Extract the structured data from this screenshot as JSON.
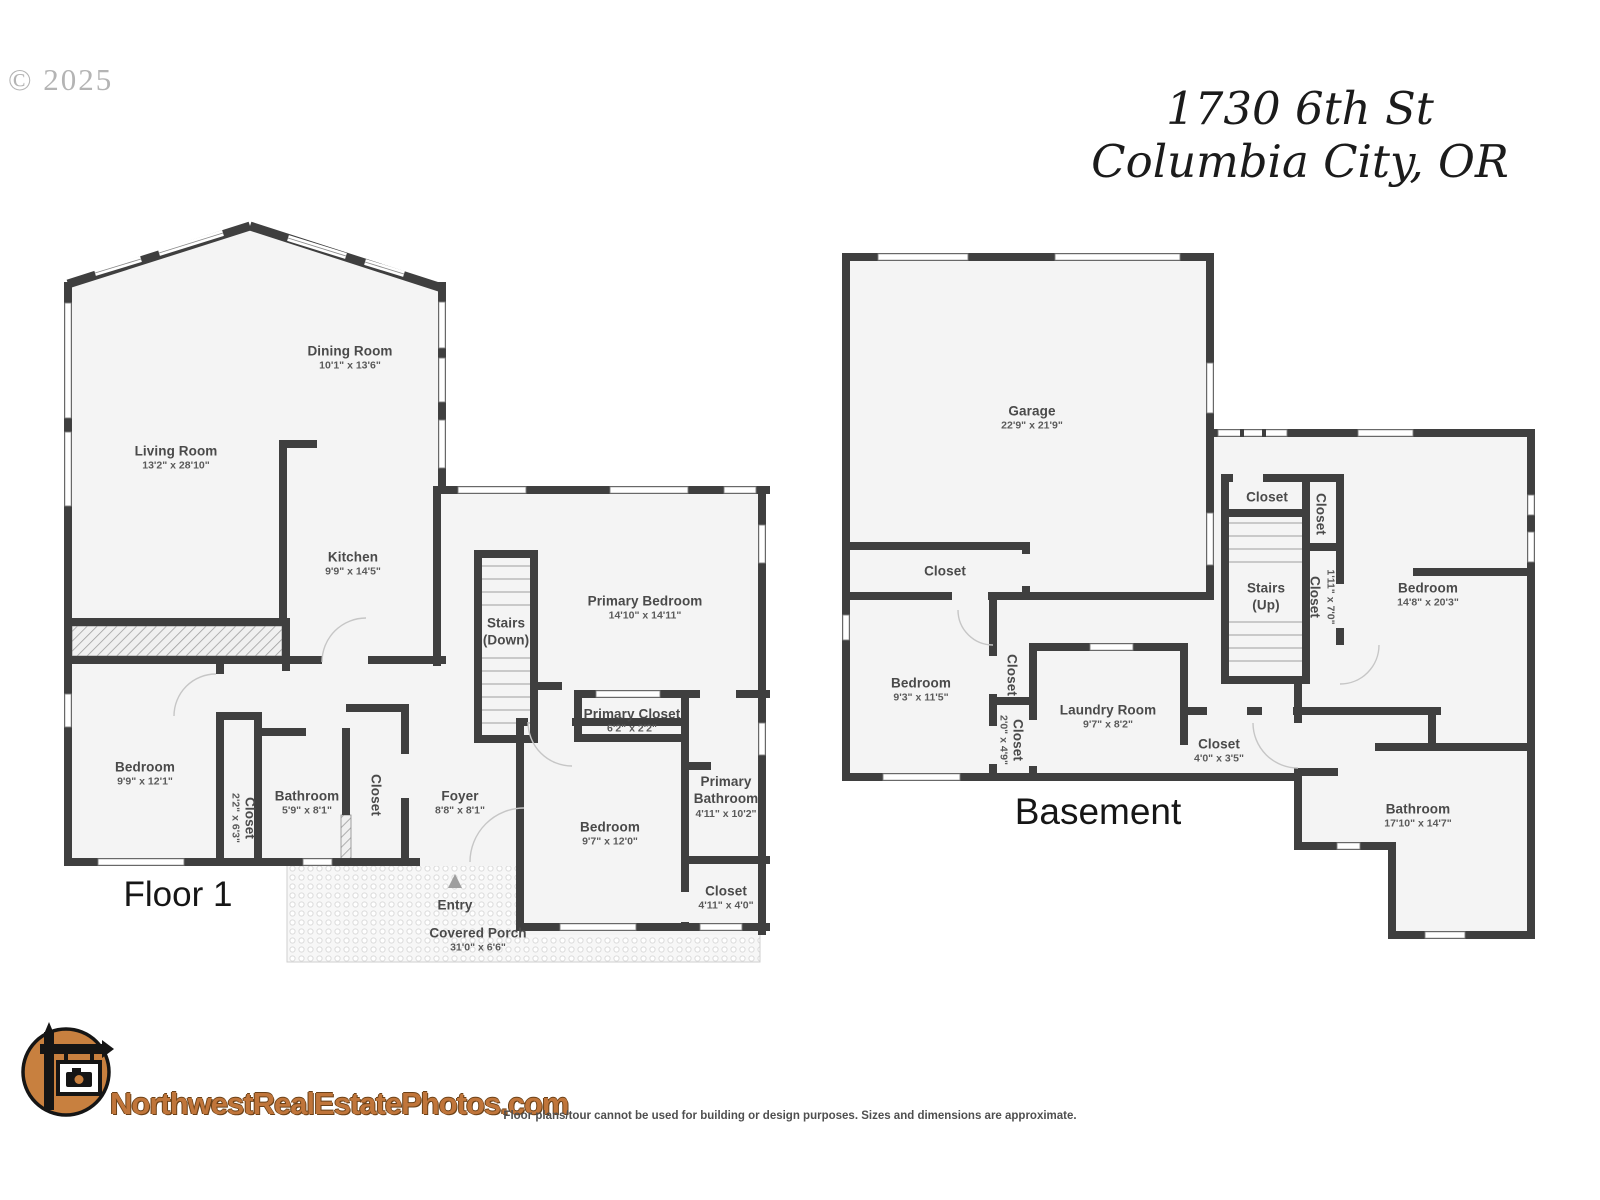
{
  "watermark": "© 2025",
  "address": {
    "line1": "1730 6th St",
    "line2": "Columbia City, OR"
  },
  "floor1": {
    "title": "Floor 1",
    "rooms": {
      "living": {
        "name": "Living Room",
        "dims": "13'2\" x 28'10\""
      },
      "dining": {
        "name": "Dining Room",
        "dims": "10'1\" x 13'6\""
      },
      "kitchen": {
        "name": "Kitchen",
        "dims": "9'9\" x 14'5\""
      },
      "stairs": {
        "name": "Stairs",
        "dims": "(Down)"
      },
      "primary_bedroom": {
        "name": "Primary Bedroom",
        "dims": "14'10\" x 14'11\""
      },
      "primary_closet": {
        "name": "Primary Closet",
        "dims": "6'2\" x 2'2\""
      },
      "primary_bathroom": {
        "name": "Primary Bathroom",
        "dims": "4'11\" x 10'2\""
      },
      "bedroom_right": {
        "name": "Bedroom",
        "dims": "9'7\" x 12'0\""
      },
      "closet_right": {
        "name": "Closet",
        "dims": "4'11\" x 4'0\""
      },
      "foyer": {
        "name": "Foyer",
        "dims": "8'8\" x 8'1\""
      },
      "bathroom": {
        "name": "Bathroom",
        "dims": "5'9\" x 8'1\""
      },
      "closet_hall": {
        "name": "Closet",
        "dims": "2'2\" x 6'3\""
      },
      "closet_foyer": {
        "name": "Closet"
      },
      "bedroom_left": {
        "name": "Bedroom",
        "dims": "9'9\" x 12'1\""
      },
      "entry": {
        "name": "Entry"
      },
      "porch": {
        "name": "Covered Porch",
        "dims": "31'0\" x 6'6\""
      }
    }
  },
  "basement": {
    "title": "Basement",
    "rooms": {
      "garage": {
        "name": "Garage",
        "dims": "22'9\" x 21'9\""
      },
      "garage_closet": {
        "name": "Closet"
      },
      "bedroom_left": {
        "name": "Bedroom",
        "dims": "9'3\" x 11'5\""
      },
      "closet_upper": {
        "name": "Closet"
      },
      "closet_lower": {
        "name": "Closet",
        "dims": "2'0\" x 4'9\""
      },
      "laundry": {
        "name": "Laundry Room",
        "dims": "9'7\" x 8'2\""
      },
      "closet_hall": {
        "name": "Closet",
        "dims": "4'0\" x 3'5\""
      },
      "stairs_closet": {
        "name": "Closet"
      },
      "closet_side": {
        "name": "Closet"
      },
      "stairs": {
        "name": "Stairs",
        "dims": "(Up)"
      },
      "closet_tall": {
        "name": "Closet",
        "dims": "1'11\" x 7'0\""
      },
      "bedroom_right": {
        "name": "Bedroom",
        "dims": "14'8\" x 20'3\""
      },
      "bathroom": {
        "name": "Bathroom",
        "dims": "17'10\" x 14'7\""
      }
    }
  },
  "branding": {
    "site": "NorthwestRealEstatePhotos.com"
  },
  "disclaimer": "Floor plans/tour cannot be used for building or design purposes. Sizes and dimensions are approximate.",
  "colors": {
    "wall": "#3f3f3f",
    "room_fill": "#f4f4f4",
    "logo_orange": "#c0753a"
  }
}
